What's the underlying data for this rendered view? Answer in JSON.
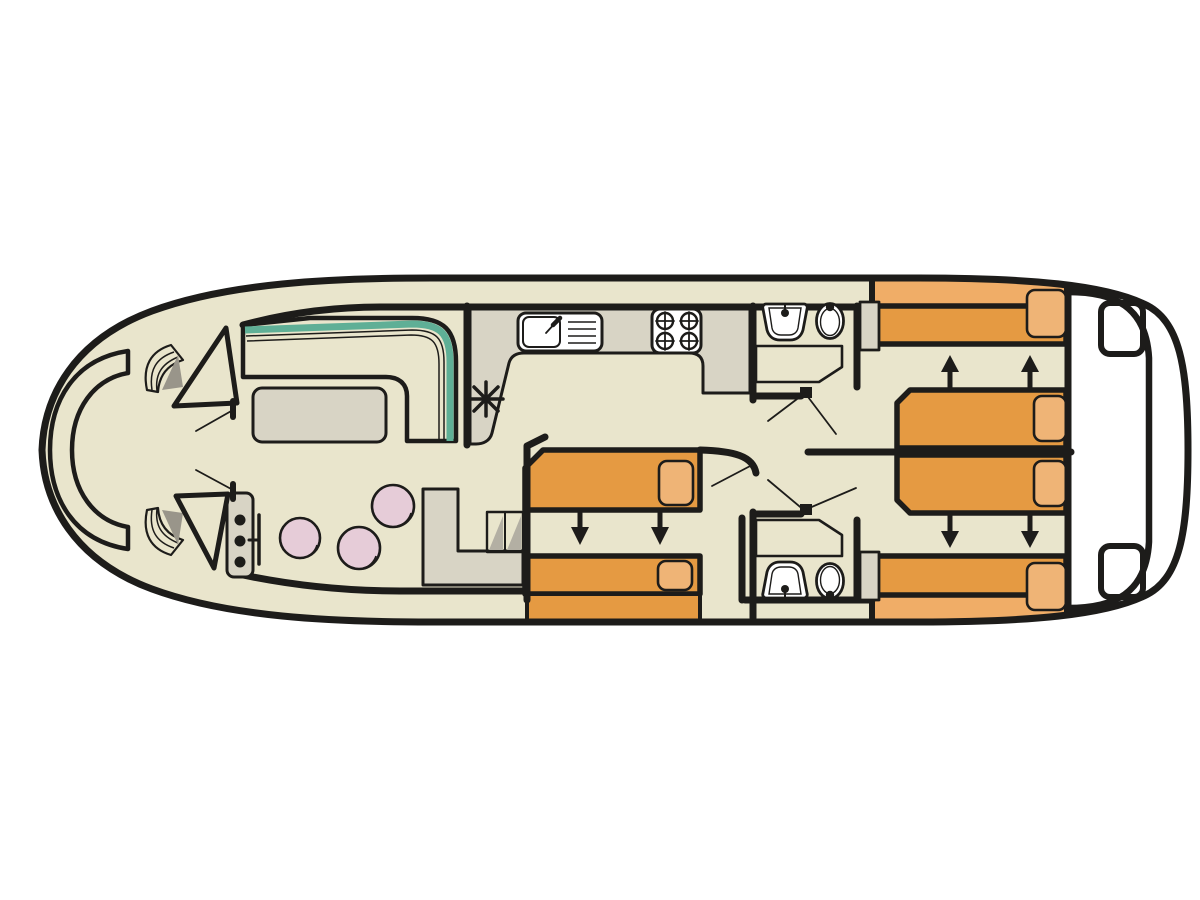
{
  "meta": {
    "type": "boat-floor-plan",
    "view": "top-down",
    "orientation": "bow-left-stern-right"
  },
  "palette": {
    "white": "#FFFFFF",
    "hull_fill": "#E9E5CC",
    "line": "#1D1C1A",
    "sofa": "#7EC4AB",
    "sofa_edge": "#5FAF96",
    "counter": "#D8D4C5",
    "bed": "#E59A42",
    "bed_light": "#F0AD67",
    "pillow": "#EFB476",
    "stool": "#E6CCD8",
    "step_shade": "#B3AFA3",
    "slat": "#CFCBC0",
    "slat_shade": "#99958A",
    "fixture": "#FFFFFF"
  },
  "areas": [
    {
      "name": "bow-deck",
      "features": [
        "curved-bench",
        "step-fan-port",
        "step-fan-starboard",
        "door-port",
        "door-starboard"
      ]
    },
    {
      "name": "saloon",
      "features": [
        "l-shaped-sofa",
        "table"
      ]
    },
    {
      "name": "galley",
      "features": [
        "counter",
        "sink",
        "stove-4-burner",
        "heater"
      ]
    },
    {
      "name": "dinette",
      "features": [
        "stool",
        "stool",
        "stool",
        "helm-console",
        "cabinet",
        "steps"
      ]
    },
    {
      "name": "shower-room-forward",
      "features": [
        "washbasin",
        "toilet",
        "shower"
      ]
    },
    {
      "name": "shower-room-aft",
      "features": [
        "washbasin",
        "toilet",
        "shower"
      ]
    },
    {
      "name": "cabin-midship",
      "features": [
        "bed",
        "bed",
        "extension-arrows"
      ]
    },
    {
      "name": "cabin-aft-port",
      "features": [
        "bed",
        "bed",
        "extension-arrows",
        "wardrobe"
      ]
    },
    {
      "name": "cabin-aft-starboard",
      "features": [
        "bed",
        "bed",
        "extension-arrows",
        "wardrobe"
      ]
    },
    {
      "name": "stern-deck",
      "features": [
        "step",
        "step"
      ]
    }
  ],
  "counts": {
    "beds": 6,
    "pillows": 6,
    "stools": 3,
    "toilets": 2,
    "washbasins": 2,
    "showers": 2,
    "stove_burners": 4,
    "extension_arrows": 8,
    "door_swings": 7
  }
}
